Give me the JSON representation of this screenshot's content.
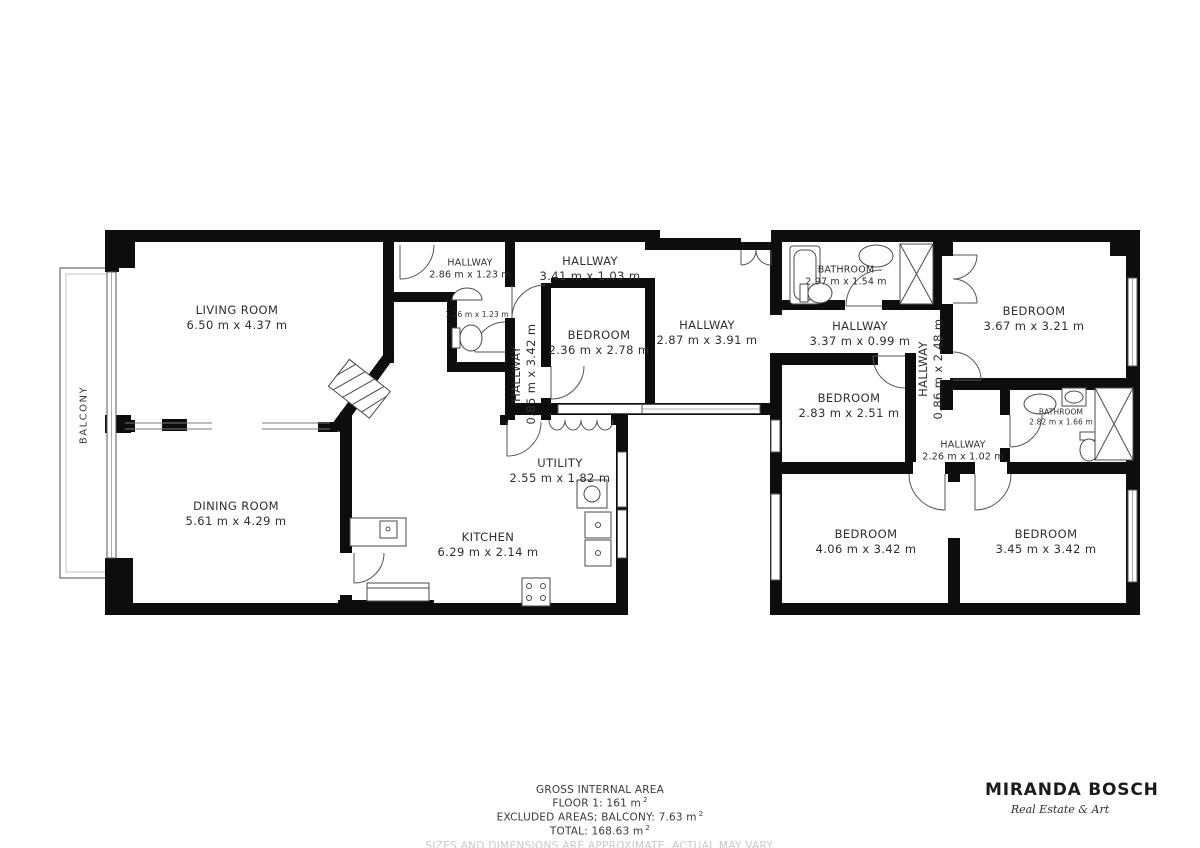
{
  "floorplan": {
    "balcony": {
      "label": "BALCONY"
    },
    "rooms": [
      {
        "name": "LIVING ROOM",
        "dims": "6.50 m x 4.37 m"
      },
      {
        "name": "DINING ROOM",
        "dims": "5.61 m x 4.29 m"
      },
      {
        "name": "KITCHEN",
        "dims": "6.29 m x 2.14 m"
      },
      {
        "name": "UTILITY",
        "dims": "2.55 m x 1.82 m"
      },
      {
        "name": "HALLWAY",
        "dims": "2.86 m x 1.23 m"
      },
      {
        "name": "HALLWAY",
        "dims": "3.41 m x 1.03 m"
      },
      {
        "name": "HALLWAY",
        "dims": "0.85 m x 3.42 m"
      },
      {
        "name": "BEDROOM",
        "dims": "2.36 m x 2.78 m"
      },
      {
        "name": "HALLWAY",
        "dims": "2.87 m x 3.91 m"
      },
      {
        "name": "BATHROOM",
        "dims": "2.97 m x 1.54 m"
      },
      {
        "name": "HALLWAY",
        "dims": "3.37 m x 0.99 m"
      },
      {
        "name": "BEDROOM",
        "dims": "2.83 m x 2.51 m"
      },
      {
        "name": "HALLWAY",
        "dims": "0.86 m x 2.48 m"
      },
      {
        "name": "BEDROOM",
        "dims": "3.67 m x 3.21 m"
      },
      {
        "name": "BATHROOM",
        "dims": "2.82 m x 1.66 m"
      },
      {
        "name": "HALLWAY",
        "dims": "2.26 m x 1.02 m"
      },
      {
        "name": "BEDROOM",
        "dims": "4.06 m x 3.42 m"
      },
      {
        "name": "BEDROOM",
        "dims": "3.45 m x 3.42 m"
      },
      {
        "name": "",
        "dims": "1.26 m x 1.23 m"
      }
    ]
  },
  "footer": {
    "title": "GROSS INTERNAL AREA",
    "floor": {
      "text": "FLOOR 1: 161 m",
      "sup": "2"
    },
    "excluded": {
      "text": "EXCLUDED AREAS; BALCONY: 7.63 m",
      "sup": "2"
    },
    "total": {
      "text": "TOTAL: 168.63 m",
      "sup": "2"
    },
    "disclaimer": "SIZES AND DIMENSIONS ARE APPROXIMATE, ACTUAL MAY VARY."
  },
  "brand": {
    "name": "MIRANDA BOSCH",
    "tagline": "Real Estate & Art"
  },
  "colors": {
    "wall": "#0d0d0d",
    "thin": "#555555",
    "label": "#2e2e2e",
    "disclaimer": "#c9c9c9"
  }
}
